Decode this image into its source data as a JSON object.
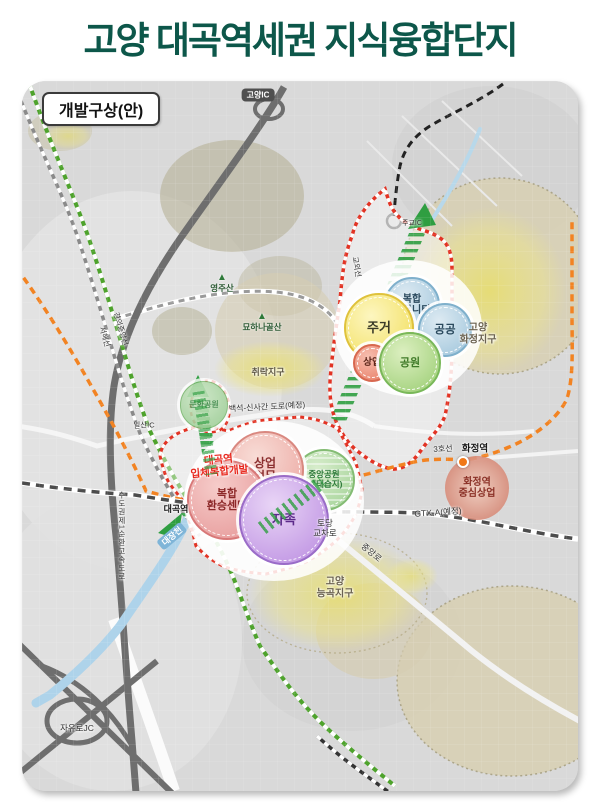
{
  "title": "고양 대곡역세권 지식융합단지",
  "map": {
    "legend_title": "개발구상(안)",
    "interchanges": {
      "goyang": "고양IC",
      "ilsan": "일산IC",
      "jugyo": "주교IC",
      "jayuro": "자유로JC"
    },
    "mountains": {
      "yeongjusan": "영주산",
      "myohanagolsan": "묘하나골산",
      "triangle_icon": "▲"
    },
    "rail_lines": {
      "gyeongui_jungang": "경의중앙선",
      "seohae": "서해선",
      "gyoe": "교외선",
      "line3": "3호선",
      "gtx_a": "GTX-A(예정)"
    },
    "roads": {
      "baekseok_sinsa": "백석-신사간 도로(예정)",
      "jungang_ro": "중앙로",
      "beltway": "수도권제1순환고속도로",
      "todang_junction": "토당\n교차로"
    },
    "stations": {
      "daegok": "대곡역",
      "hwajeong": "화정역"
    },
    "river": {
      "daejangcheon": "대장천"
    },
    "districts": {
      "chwirak": "취락지구",
      "hwajeong": "고양\n화정지구",
      "neunggok": "고양\n능곡지구"
    },
    "dev_note": "대곡역\n입체복합개발",
    "bubbles": {
      "north": [
        {
          "label": "복합\n커뮤니티"
        },
        {
          "label": "주거"
        },
        {
          "label": "공공"
        },
        {
          "label": "상업"
        },
        {
          "label": "공원"
        }
      ],
      "south": [
        {
          "label": "상업\n업무"
        },
        {
          "label": "복합\n환승센터"
        },
        {
          "label": "자족"
        },
        {
          "label": "중앙공원\n(생태습지)"
        }
      ],
      "west_park": "문화공원",
      "hwajeong_commercial": "화정역\n중심상업"
    },
    "colors": {
      "title_green": "#0d574a",
      "boundary_red": "#e23324",
      "green_axis": "#2f9e41",
      "line3_orange": "#f28322",
      "gtx_gray": "#4c4c4c",
      "water_blue": "#aed3ea",
      "district_yellow": "#eae060",
      "residential_yellow": "#f0dc52",
      "public_blue": "#9cc3da",
      "park_green": "#98cc70",
      "commercial_red": "#e87860",
      "self_sufficiency_purple": "#b98ae0"
    }
  }
}
